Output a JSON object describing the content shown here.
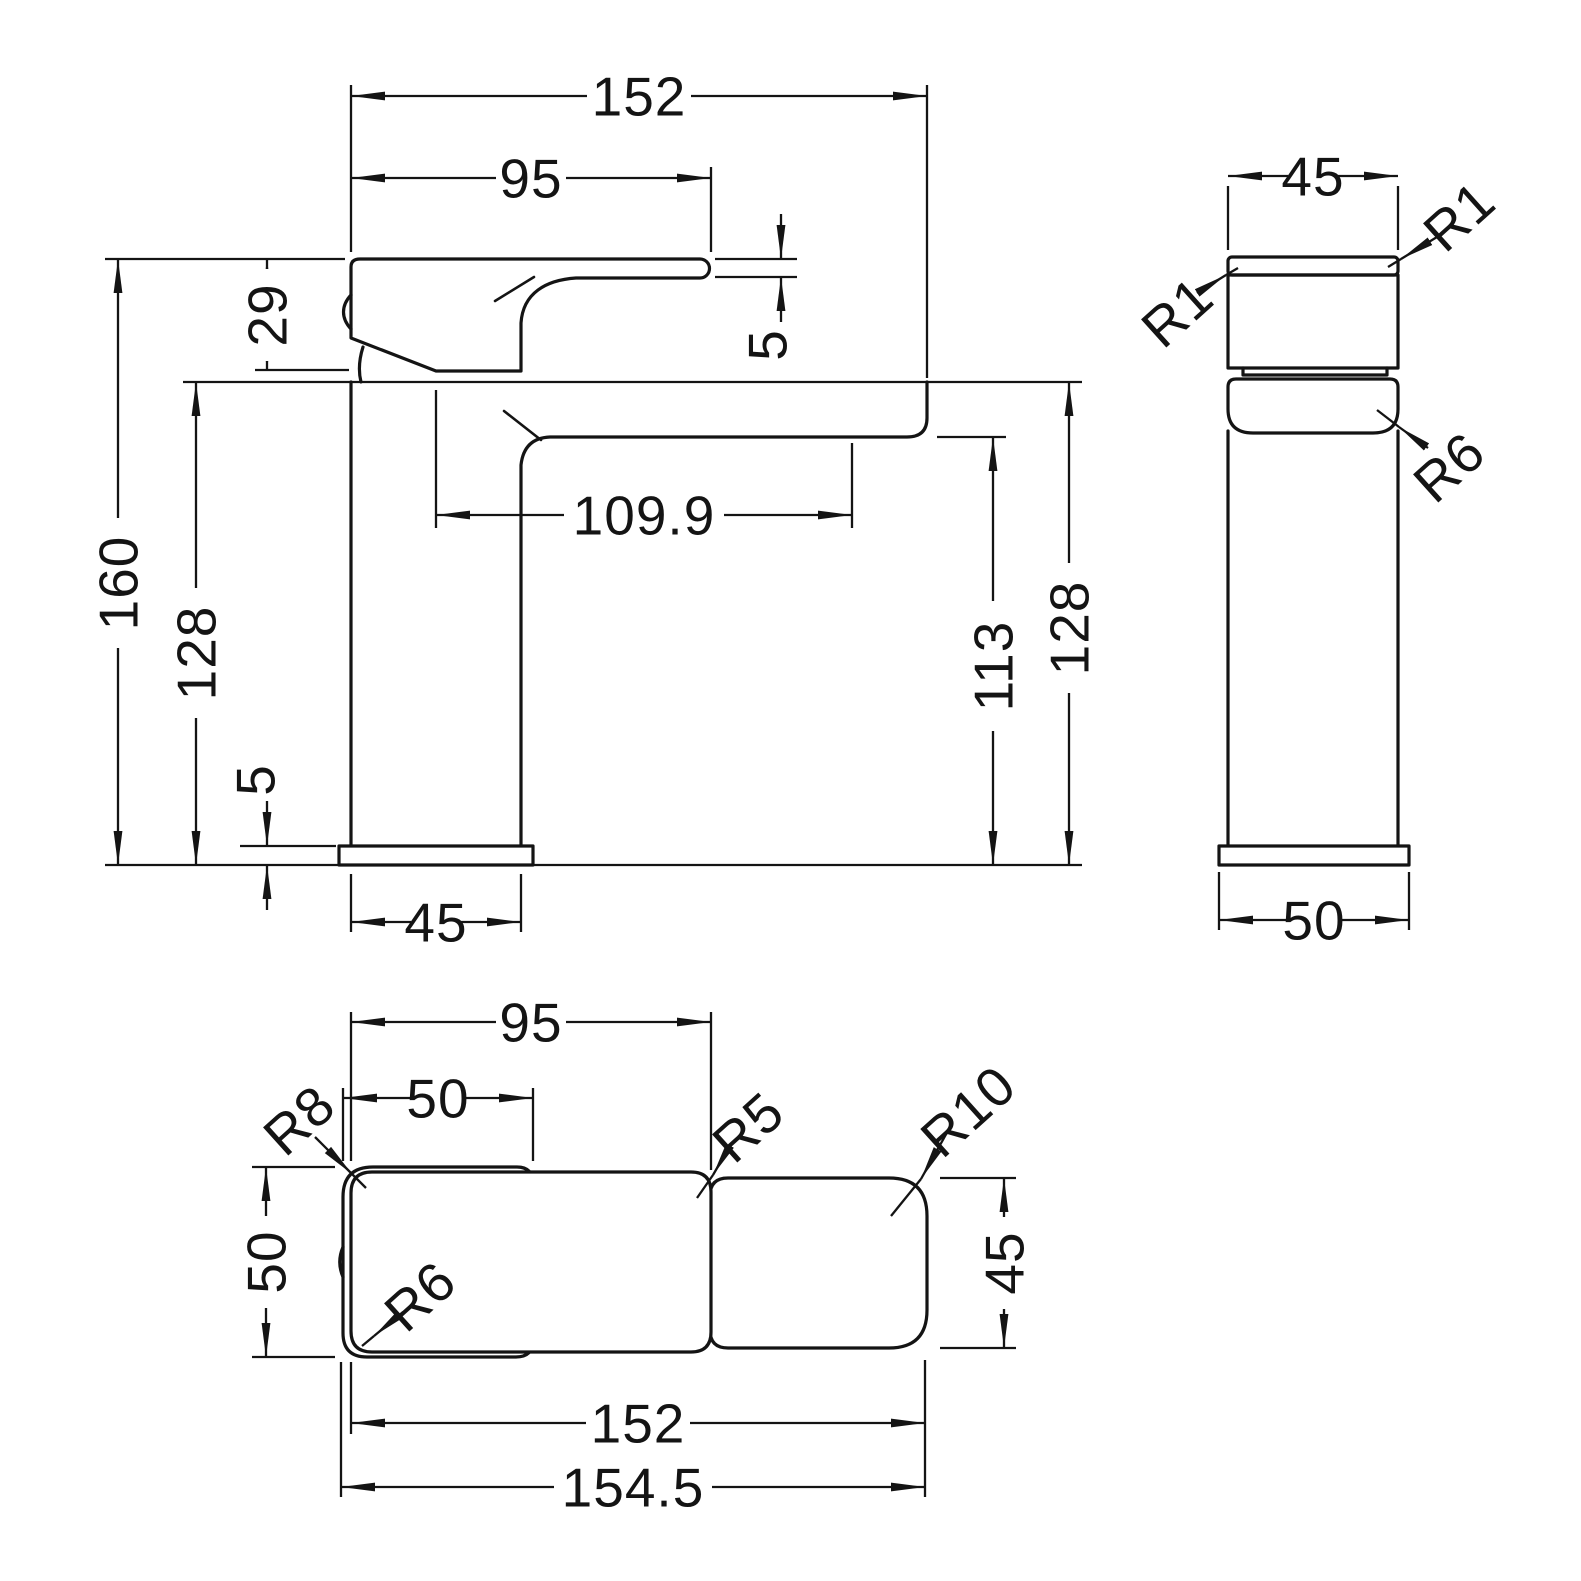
{
  "front": {
    "overall_length": "152",
    "handle_length": "95",
    "handle_height": "29",
    "lever_tip_thickness": "5",
    "total_height": "160",
    "deck_to_base_left": "128",
    "spout_reach": "109.9",
    "spout_clearance": "113",
    "deck_to_base_right": "128",
    "base_plate_thickness": "5",
    "column_width": "45"
  },
  "side": {
    "cap_width": "45",
    "cap_radius_right": "R1",
    "cap_radius_left": "R1",
    "shoulder_radius": "R6",
    "base_width": "50"
  },
  "plan": {
    "handle_length": "95",
    "body_length": "50",
    "rear_corner_radius": "R8",
    "mid_corner_radius": "R5",
    "spout_corner_radius": "R10",
    "body_width": "50",
    "body_front_radius": "R6",
    "spout_width": "45",
    "length_to_spout": "152",
    "overall_length": "154.5"
  }
}
